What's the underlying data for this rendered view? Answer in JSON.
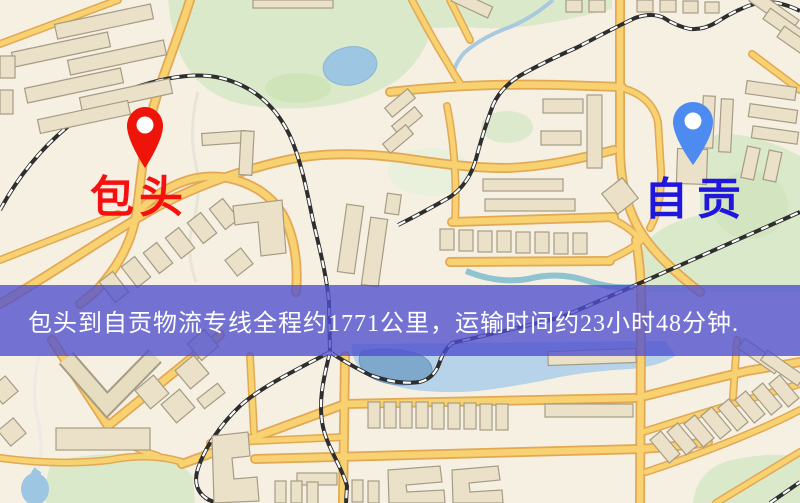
{
  "banner": {
    "text": "包头到自贡物流专线全程约1771公里，运输时间约23小时48分钟.",
    "background_color": "#4e4ece",
    "text_color": "#ffffff"
  },
  "markers": {
    "origin": {
      "label": "包头",
      "label_color": "#f61010",
      "pin_color": "#ee1409",
      "pin_icon": "map-pin"
    },
    "destination": {
      "label": "自贡",
      "label_color": "#2016dc",
      "pin_color": "#4d8bf0",
      "pin_icon": "map-pin"
    }
  },
  "route": {
    "from": "包头",
    "to": "自贡",
    "distance_text": "约1771公里",
    "duration_text": "约23小时48分钟"
  },
  "map_palette": {
    "background": "#f6f0e3",
    "road_fill": "#f8d271",
    "road_casing": "#e2a855",
    "building_fill": "#eae1c8",
    "building_stroke": "#a69c84",
    "green_area": "#dbe9cb",
    "water": "#b7d3e9",
    "lake": "#7fa9cc",
    "railway": "#2e2e2e"
  }
}
